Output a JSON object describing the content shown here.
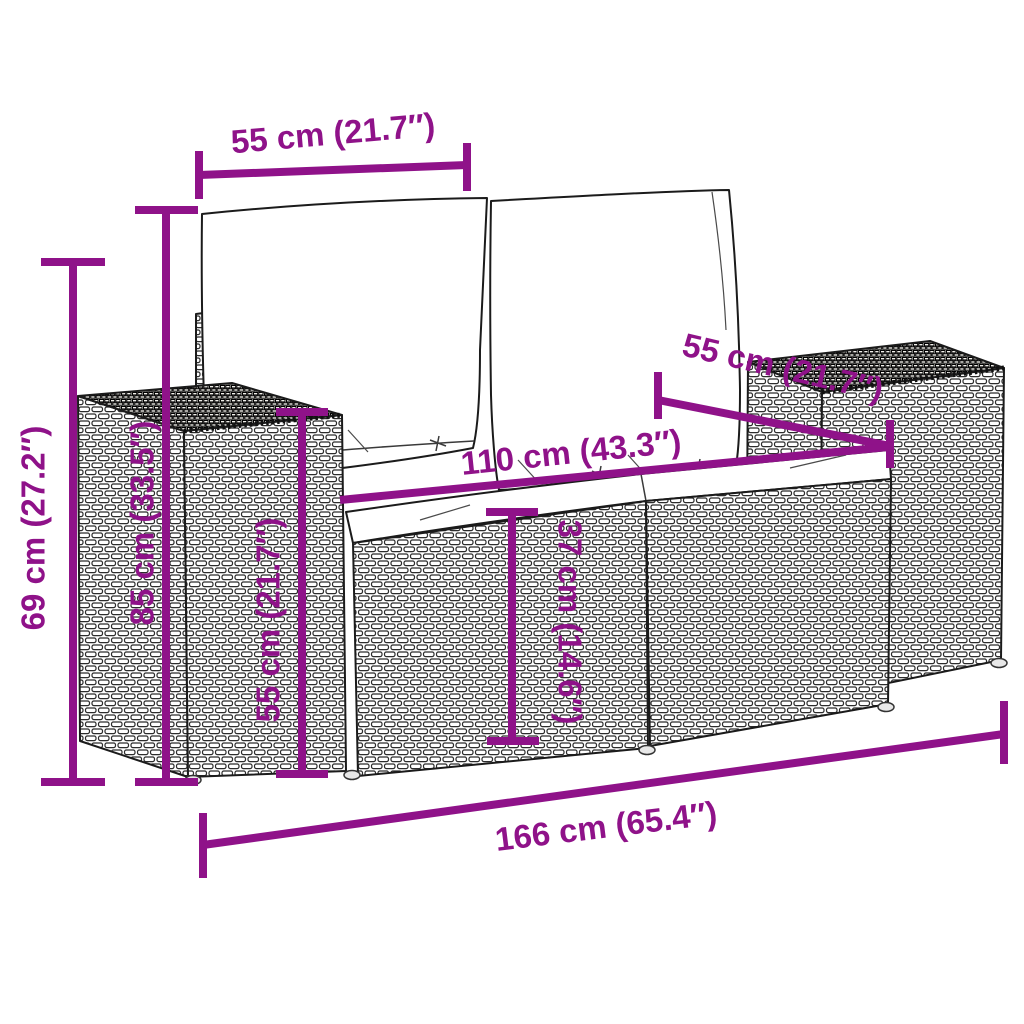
{
  "diagram": {
    "type": "product-dimension-diagram",
    "subject": "2-seater poly rattan garden sofa with back and seat cushions",
    "accent_color": "#8F1289",
    "line_art_color": "#1b1b1b",
    "background_color": "#ffffff",
    "dimensions": [
      {
        "id": "back-cushion-width",
        "label": "55 cm (21.7″)",
        "value_cm": 55,
        "value_in": 21.7,
        "orientation": "horizontal-top"
      },
      {
        "id": "seat-depth",
        "label": "55 cm (21.7″)",
        "value_cm": 55,
        "value_in": 21.7,
        "orientation": "diagonal-depth"
      },
      {
        "id": "seat-width",
        "label": "110 cm (43.3″)",
        "value_cm": 110,
        "value_in": 43.3,
        "orientation": "horizontal-seat"
      },
      {
        "id": "total-height",
        "label": "69 cm (27.2″)",
        "value_cm": 69,
        "value_in": 27.2,
        "orientation": "vertical-left-outer"
      },
      {
        "id": "back-height",
        "label": "85 cm (33.5″)",
        "value_cm": 85,
        "value_in": 33.5,
        "orientation": "vertical-left-inner"
      },
      {
        "id": "armrest-height",
        "label": "55 cm (21.7″)",
        "value_cm": 55,
        "value_in": 21.7,
        "orientation": "vertical-armrest"
      },
      {
        "id": "seat-height",
        "label": "37 cm (14.6″)",
        "value_cm": 37,
        "value_in": 14.6,
        "orientation": "vertical-seat-front"
      },
      {
        "id": "total-width",
        "label": "166 cm (65.4″)",
        "value_cm": 166,
        "value_in": 65.4,
        "orientation": "horizontal-bottom"
      }
    ]
  }
}
